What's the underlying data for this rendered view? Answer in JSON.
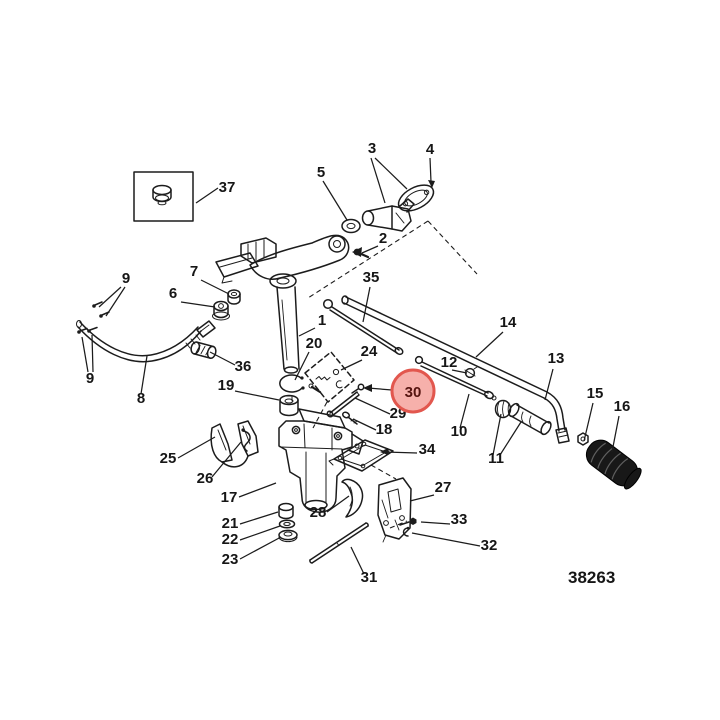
{
  "figure": {
    "drawing_number": "38263",
    "colors": {
      "background": "#ffffff",
      "ink": "#1c1c1c",
      "highlight_fill": "#f6b0ab",
      "highlight_ring": "#e2574e",
      "highlight_text": "#551410"
    },
    "highlight": {
      "text": "30"
    },
    "callouts": [
      {
        "text": "37"
      },
      {
        "text": "5"
      },
      {
        "text": "3"
      },
      {
        "text": "4"
      },
      {
        "text": "2"
      },
      {
        "text": "35"
      },
      {
        "text": "9"
      },
      {
        "text": "7"
      },
      {
        "text": "6"
      },
      {
        "text": "1"
      },
      {
        "text": "9"
      },
      {
        "text": "8"
      },
      {
        "text": "36"
      },
      {
        "text": "20"
      },
      {
        "text": "19"
      },
      {
        "text": "24"
      },
      {
        "text": "29"
      },
      {
        "text": "18"
      },
      {
        "text": "12"
      },
      {
        "text": "14"
      },
      {
        "text": "13"
      },
      {
        "text": "10"
      },
      {
        "text": "11"
      },
      {
        "text": "15"
      },
      {
        "text": "16"
      },
      {
        "text": "25"
      },
      {
        "text": "26"
      },
      {
        "text": "17"
      },
      {
        "text": "21"
      },
      {
        "text": "22"
      },
      {
        "text": "23"
      },
      {
        "text": "28"
      },
      {
        "text": "34"
      },
      {
        "text": "27"
      },
      {
        "text": "33"
      },
      {
        "text": "32"
      },
      {
        "text": "31"
      }
    ]
  }
}
